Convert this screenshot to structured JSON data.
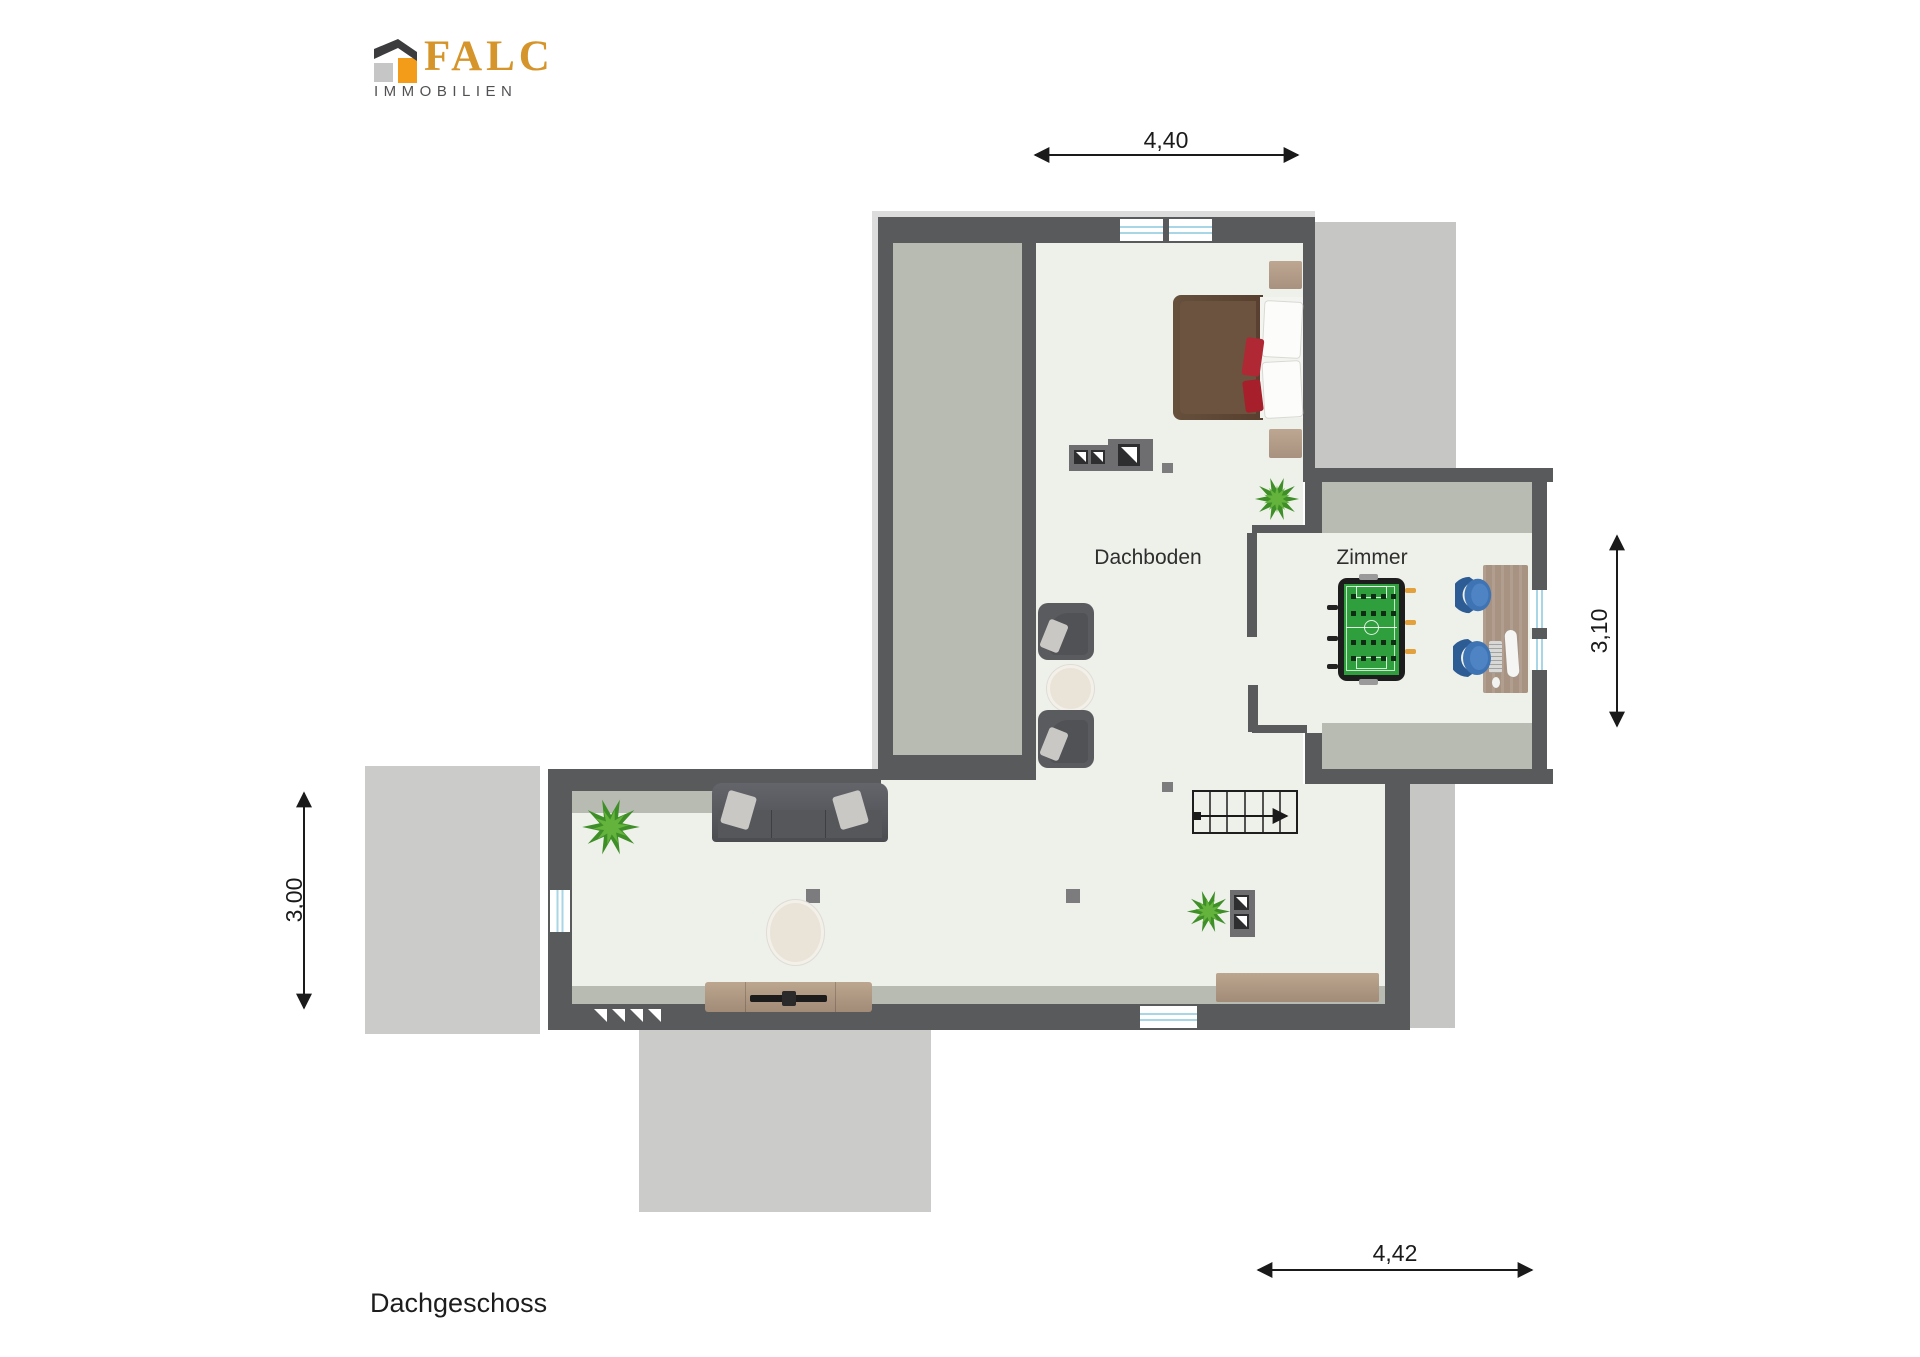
{
  "logo": {
    "brand": "FALC",
    "subtitle": "IMMOBILIEN",
    "icon": "falc-house-logo-icon",
    "brand_color": "#d6952a",
    "subtitle_color": "#515153"
  },
  "plan": {
    "floor_label": "Dachgeschoss",
    "rooms": [
      {
        "name": "Dachboden"
      },
      {
        "name": "Zimmer"
      }
    ],
    "dimensions": {
      "top": "4,40",
      "right": "3,10",
      "left": "3,00",
      "bottom": "4,42"
    }
  },
  "colors": {
    "wall": "#595a5c",
    "floor": "#eef0ea",
    "roof_area_light": "#cbcbca",
    "roof_area_mid": "#c6c6c5",
    "interior_gray": "#b8bbb2",
    "window_blue": "#a9d6e6",
    "dimension_line": "#1a1a1a",
    "foosball_green": "#2f9e3d",
    "chair_blue": "#3f74b4",
    "bed_brown": "#5f4736",
    "wood_tan": "#ab9482"
  },
  "furniture": [
    "double-bed",
    "nightstand",
    "nightstand",
    "chest-of-drawers",
    "plant",
    "plant",
    "plant",
    "armchair",
    "armchair",
    "side-table",
    "sofa",
    "coffee-table",
    "tv-sideboard",
    "sideboard",
    "shelf-unit",
    "staircase",
    "foosball-table",
    "desk",
    "office-chair",
    "office-chair",
    "monitor",
    "keyboard",
    "mouse"
  ]
}
